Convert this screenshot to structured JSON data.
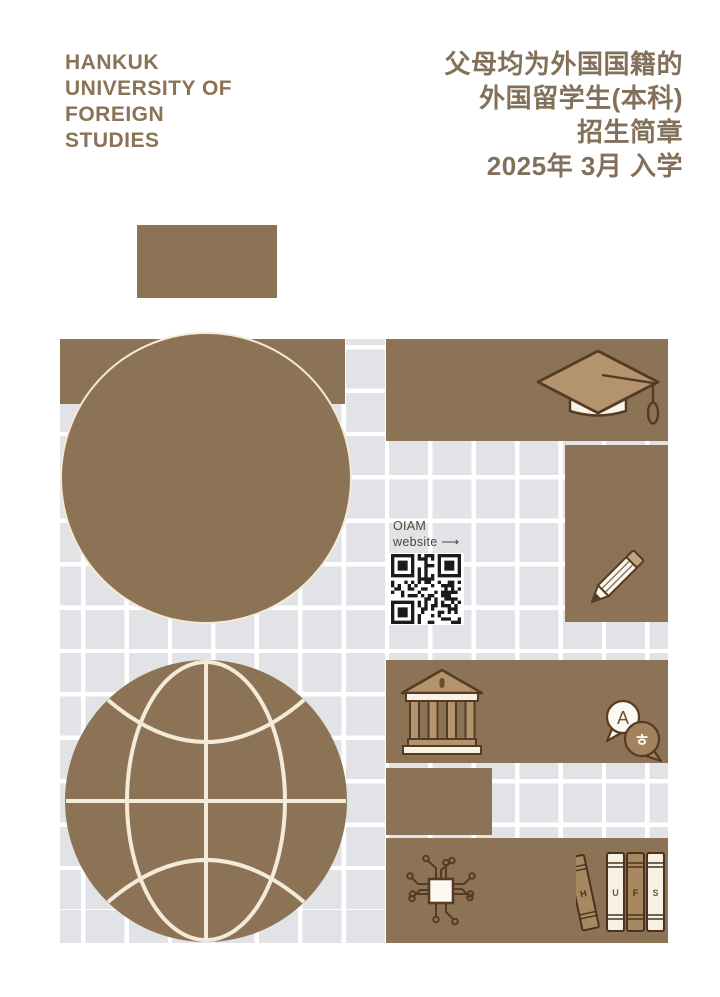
{
  "logo": {
    "lines": [
      "HANKUK",
      "UNIVERSITY OF",
      "FOREIGN",
      "STUDIES"
    ]
  },
  "title": {
    "lines": [
      "父母均为外国国籍的",
      "外国留学生(本科)",
      "招生简章",
      "2025年 3月 入学"
    ]
  },
  "qr": {
    "line1": "OIAM",
    "line2": "website ⟶"
  },
  "books": {
    "letters": [
      "H",
      "U",
      "F",
      "S"
    ]
  },
  "translation": {
    "latin": "A",
    "korean": "ㅎ"
  },
  "icons": [
    "graduation-cap",
    "pencil",
    "globe",
    "university-building",
    "translation-bubbles",
    "circuit-chip",
    "books",
    "qr-code"
  ],
  "colors": {
    "brand_brown": "#8c7356",
    "light_brown": "#b3946e",
    "grid_gray": "#e2e3e6",
    "cream": "#f3ead7",
    "outline_brown": "#553b24",
    "text_brown": "#83705a",
    "background": "#ffffff"
  }
}
